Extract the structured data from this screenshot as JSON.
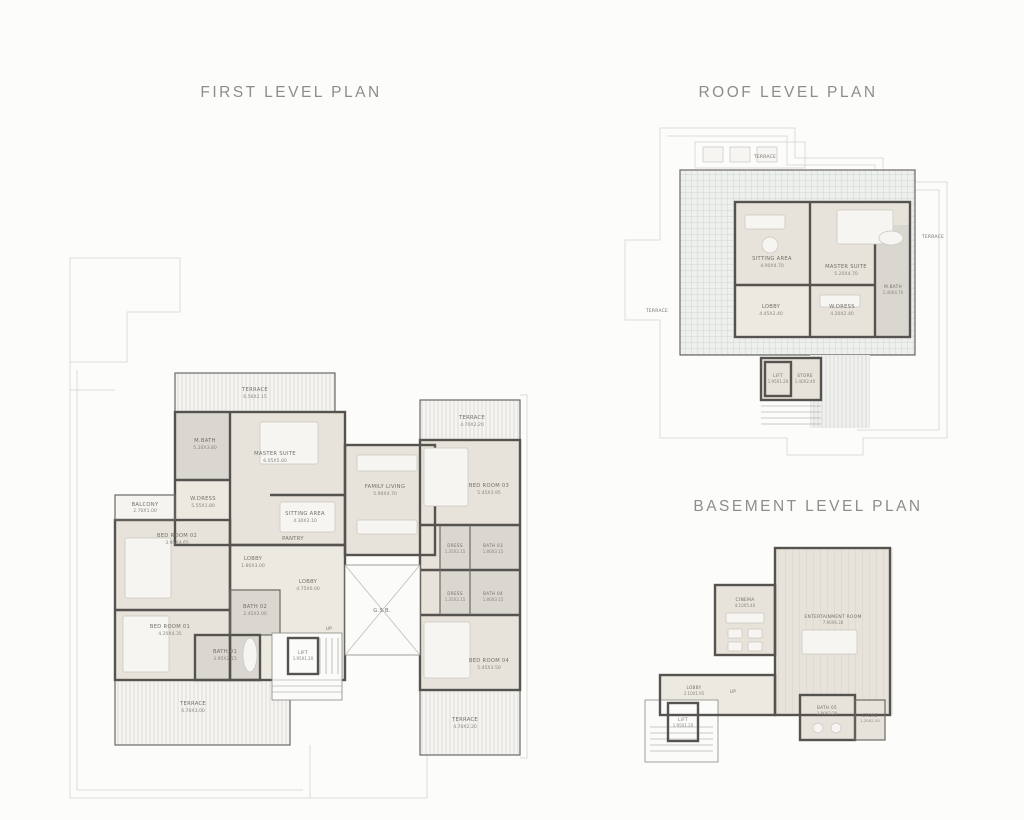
{
  "palette": {
    "background": "#fcfcfb",
    "title_color": "#8d8d8b",
    "wall_color": "#55534f",
    "room_fill": "#e7e3da",
    "terrace_fill": "#f5f4f1",
    "label_color": "#73706a"
  },
  "plans": {
    "first": {
      "title": "FIRST LEVEL PLAN",
      "rooms": [
        {
          "name": "TERRACE",
          "dim": "6.56X2.15"
        },
        {
          "name": "M.BATH",
          "dim": "5.20X3.80"
        },
        {
          "name": "MASTER SUITE",
          "dim": "6.05X5.60"
        },
        {
          "name": "W.DRESS",
          "dim": "5.55X1.80"
        },
        {
          "name": "SITTING AREA",
          "dim": "4.30X2.10"
        },
        {
          "name": "FAMILY LIVING",
          "dim": "5.90X4.70"
        },
        {
          "name": "PANTRY",
          "dim": ""
        },
        {
          "name": "BALCONY",
          "dim": "2.70X1.00"
        },
        {
          "name": "BED ROOM 02",
          "dim": "3.95X4.65"
        },
        {
          "name": "LOBBY",
          "dim": "1.80X3.00"
        },
        {
          "name": "BATH 02",
          "dim": "2.45X2.00"
        },
        {
          "name": "BED ROOM 01",
          "dim": "4.20X4.35"
        },
        {
          "name": "BATH 01",
          "dim": "3.95X2.15"
        },
        {
          "name": "LOBBY",
          "dim": "4.75X6.00"
        },
        {
          "name": "LIFT",
          "dim": "1.95X1.20"
        },
        {
          "name": "G.S.B.",
          "dim": ""
        },
        {
          "name": "UP",
          "dim": ""
        },
        {
          "name": "TERRACE",
          "dim": "6.70X3.00"
        },
        {
          "name": "TERRACE",
          "dim": "4.70X2.20"
        },
        {
          "name": "BED ROOM 03",
          "dim": "5.45X3.95"
        },
        {
          "name": "DRESS",
          "dim": "1.35X2.15"
        },
        {
          "name": "BATH 03",
          "dim": "1.80X3.15"
        },
        {
          "name": "DRESS",
          "dim": "1.35X2.15"
        },
        {
          "name": "BATH 04",
          "dim": "1.80X3.15"
        },
        {
          "name": "BED ROOM 04",
          "dim": "5.45X3.50"
        },
        {
          "name": "TERRACE",
          "dim": "4.70X2.20"
        }
      ]
    },
    "roof": {
      "title": "ROOF LEVEL PLAN",
      "rooms": [
        {
          "name": "TERRACE",
          "dim": ""
        },
        {
          "name": "SITTING AREA",
          "dim": "4.90X4.70"
        },
        {
          "name": "MASTER SUITE",
          "dim": "5.20X4.70"
        },
        {
          "name": "LOBBY",
          "dim": "4.45X2.40"
        },
        {
          "name": "W.DRESS",
          "dim": "4.20X2.40"
        },
        {
          "name": "M.BATH",
          "dim": "2.40X4.70"
        },
        {
          "name": "TERRACE",
          "dim": ""
        },
        {
          "name": "TERRACE",
          "dim": ""
        },
        {
          "name": "LIFT",
          "dim": "1.95X1.20"
        },
        {
          "name": "STORE",
          "dim": "1.40X2.40"
        }
      ]
    },
    "basement": {
      "title": "BASEMENT LEVEL PLAN",
      "rooms": [
        {
          "name": "CINEMA",
          "dim": "4.10X5.40"
        },
        {
          "name": "ENTERTAINMENT ROOM",
          "dim": "7.90X6.30"
        },
        {
          "name": "LOBBY",
          "dim": "2.10X1.95"
        },
        {
          "name": "LIFT",
          "dim": "1.95X1.20"
        },
        {
          "name": "BATH 05",
          "dim": "2.80X2.20"
        },
        {
          "name": "STORE",
          "dim": "1.20X2.20"
        },
        {
          "name": "UP",
          "dim": ""
        }
      ]
    }
  }
}
